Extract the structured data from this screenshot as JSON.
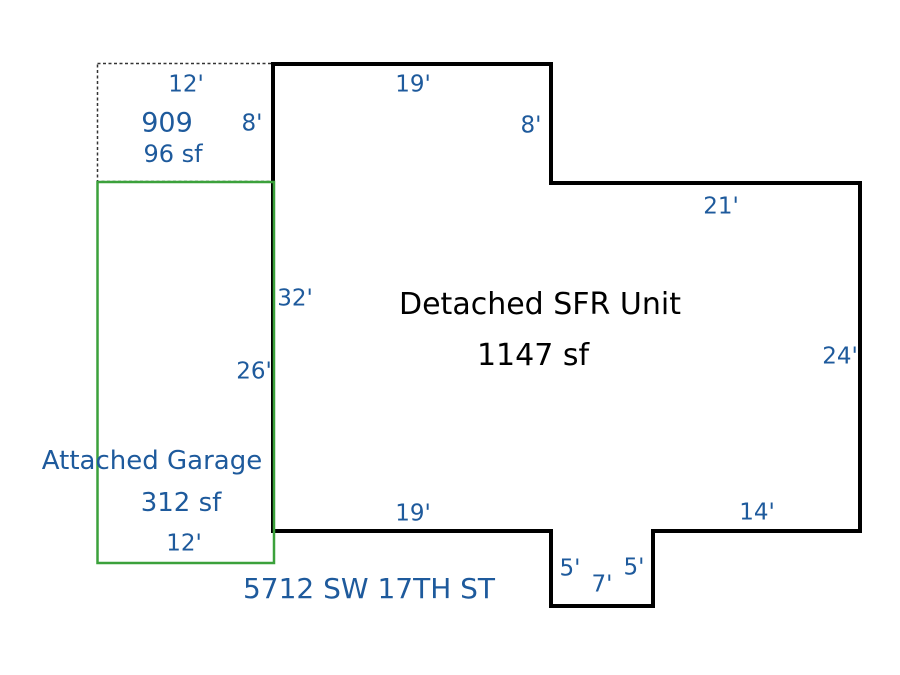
{
  "sketch": {
    "address": "5712 SW 17TH ST",
    "unit": {
      "name": "Detached SFR Unit",
      "area": "1147 sf",
      "dims": {
        "top": "19'",
        "step_height": "8'",
        "step_width": "21'",
        "right": "24'",
        "bottom_right": "14'",
        "notch_right": "5'",
        "notch_bottom": "7'",
        "notch_left": "5'",
        "bottom_left": "19'",
        "left": "32'"
      }
    },
    "garage": {
      "name": "Attached Garage",
      "area": "312 sf",
      "width": "12'",
      "height": "26'"
    },
    "porch": {
      "code": "909",
      "area": "96 sf",
      "width": "12'",
      "height": "8'"
    },
    "colors": {
      "background": "#ffffff",
      "unit_outline": "#000000",
      "unit_text": "#000000",
      "garage_outline": "#3ba13b",
      "porch_outline": "#333333",
      "dimension_text": "#1e5a9c"
    }
  }
}
